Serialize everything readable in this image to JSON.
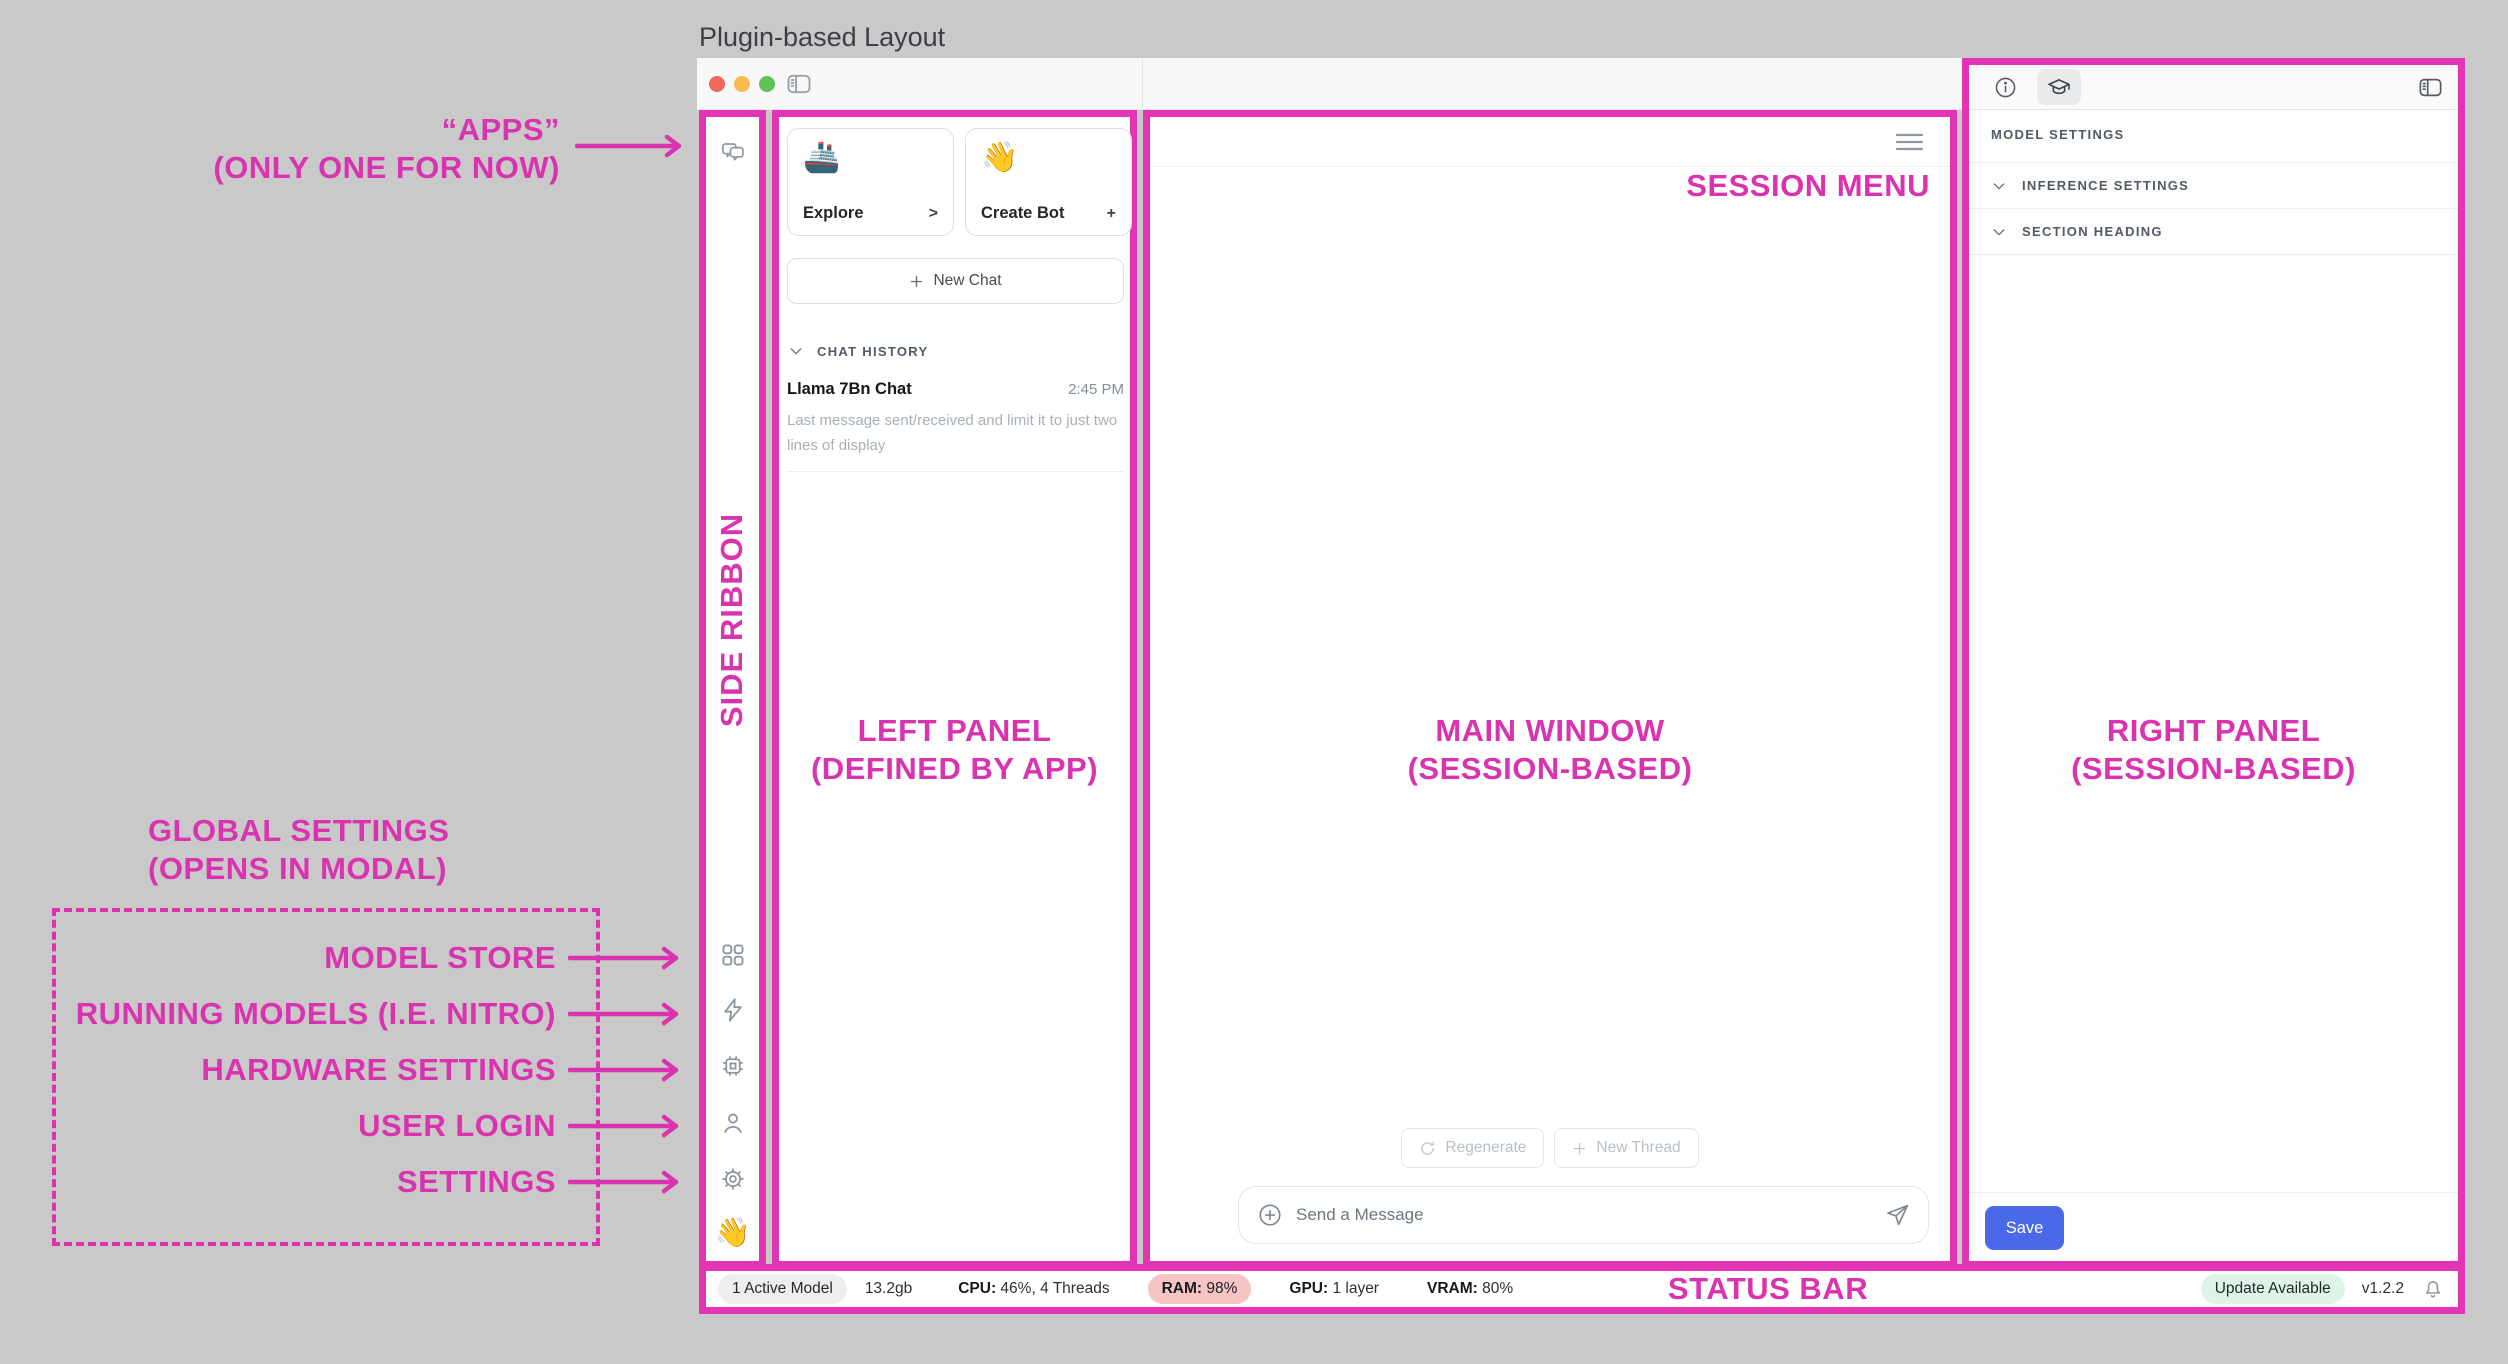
{
  "page_title": "Plugin-based Layout",
  "annotations": {
    "accent_color": "#d933af",
    "apps_line1": "“APPS”",
    "apps_line2": "(ONLY ONE FOR NOW)",
    "side_ribbon": "SIDE RIBBON",
    "left_panel_line1": "LEFT PANEL",
    "left_panel_line2": "(DEFINED BY APP)",
    "main_window_line1": "MAIN WINDOW",
    "main_window_line2": "(SESSION-BASED)",
    "right_panel_line1": "RIGHT PANEL",
    "right_panel_line2": "(SESSION-BASED)",
    "session_menu": "SESSION MENU",
    "status_bar": "STATUS BAR",
    "global_settings_line1": "GLOBAL SETTINGS",
    "global_settings_line2": "(OPENS IN MODAL)",
    "global_items": [
      "MODEL STORE",
      "RUNNING MODELS (I.E. NITRO)",
      "HARDWARE SETTINGS",
      "USER LOGIN",
      "SETTINGS"
    ]
  },
  "left_panel": {
    "explore_card": {
      "emoji": "🚢",
      "label": "Explore",
      "affordance": ">"
    },
    "create_bot_card": {
      "emoji": "👋",
      "label": "Create Bot",
      "affordance": "+"
    },
    "new_chat_label": "New Chat",
    "chat_history_header": "CHAT HISTORY",
    "chat": {
      "title": "Llama 7Bn Chat",
      "time": "2:45 PM",
      "preview": "Last message sent/received and limit it to just two lines of display"
    }
  },
  "main_window": {
    "regenerate_label": "Regenerate",
    "new_thread_label": "New Thread",
    "message_placeholder": "Send a Message"
  },
  "right_panel": {
    "heading": "MODEL SETTINGS",
    "sections": [
      "INFERENCE SETTINGS",
      "SECTION HEADING"
    ],
    "save_label": "Save"
  },
  "ribbon": {
    "hand_emoji": "👋"
  },
  "status_bar": {
    "active_model": "1 Active Model",
    "size": "13.2gb",
    "cpu_label": "CPU:",
    "cpu_value": " 46%, 4 Threads",
    "ram_label": "RAM:",
    "ram_value": " 98%",
    "gpu_label": "GPU:",
    "gpu_value": " 1 layer",
    "vram_label": "VRAM:",
    "vram_value": " 80%",
    "update_badge": "Update Available",
    "version": "v1.2.2"
  }
}
